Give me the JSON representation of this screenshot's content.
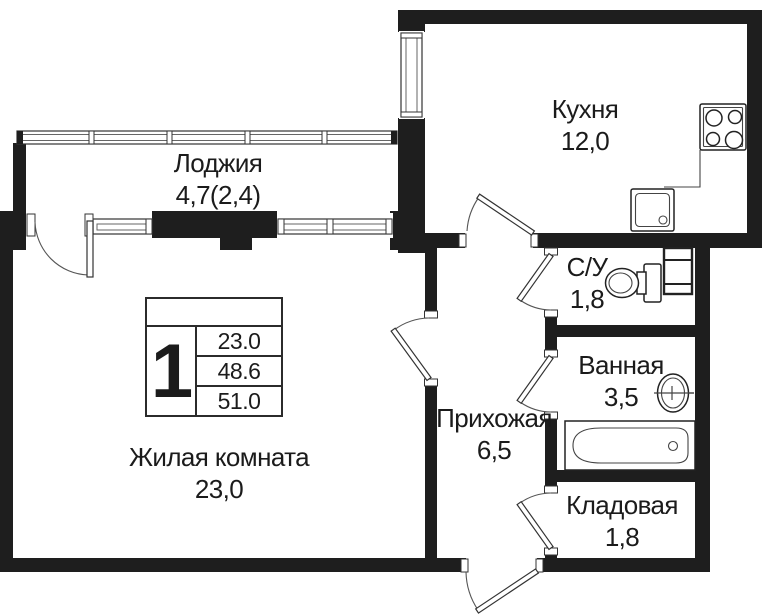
{
  "plan": {
    "rooms": {
      "loggia": {
        "name": "Лоджия",
        "area": "4,7(2,4)"
      },
      "kitchen": {
        "name": "Кухня",
        "area": "12,0"
      },
      "wc": {
        "name": "С/У",
        "area": "1,8"
      },
      "bathroom": {
        "name": "Ванная",
        "area": "3,5"
      },
      "hallway": {
        "name": "Прихожая",
        "area": "6,5"
      },
      "storage": {
        "name": "Кладовая",
        "area": "1,8"
      },
      "living_room": {
        "name": "Жилая комната",
        "area": "23,0"
      }
    },
    "info_table": {
      "rooms_count": "1",
      "rows": [
        "23.0",
        "48.6",
        "51.0"
      ]
    },
    "fixtures": [
      "stove",
      "kitchen-sink",
      "toilet",
      "bathroom-sink",
      "bathtub",
      "ventilation-shaft"
    ],
    "colors": {
      "wall": "#1e1e1e",
      "line": "#555555",
      "background": "#ffffff"
    }
  }
}
